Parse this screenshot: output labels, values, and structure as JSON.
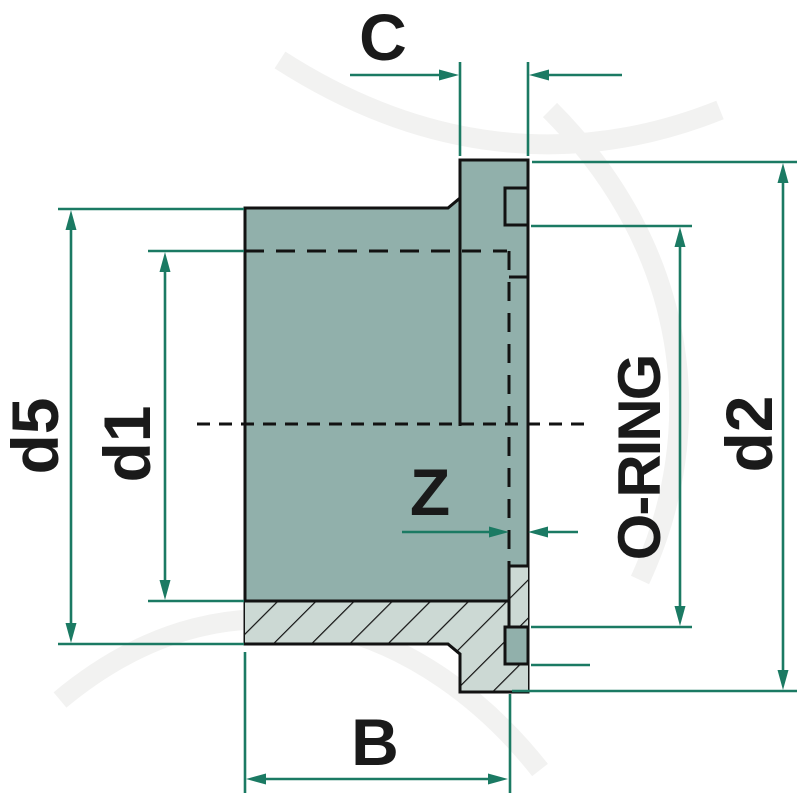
{
  "drawing": {
    "labels": {
      "c": "C",
      "d5": "d5",
      "d1": "d1",
      "z": "Z",
      "oring": "O-RING",
      "d2": "d2",
      "b": "B"
    }
  },
  "colors": {
    "bg": "#FFFFFF",
    "body-fill": "#91B0AB",
    "hatch-fill": "#CCD9D4",
    "outline": "#121212",
    "line-teal": "#1B7A63",
    "label-color": "#1A1A1A"
  }
}
